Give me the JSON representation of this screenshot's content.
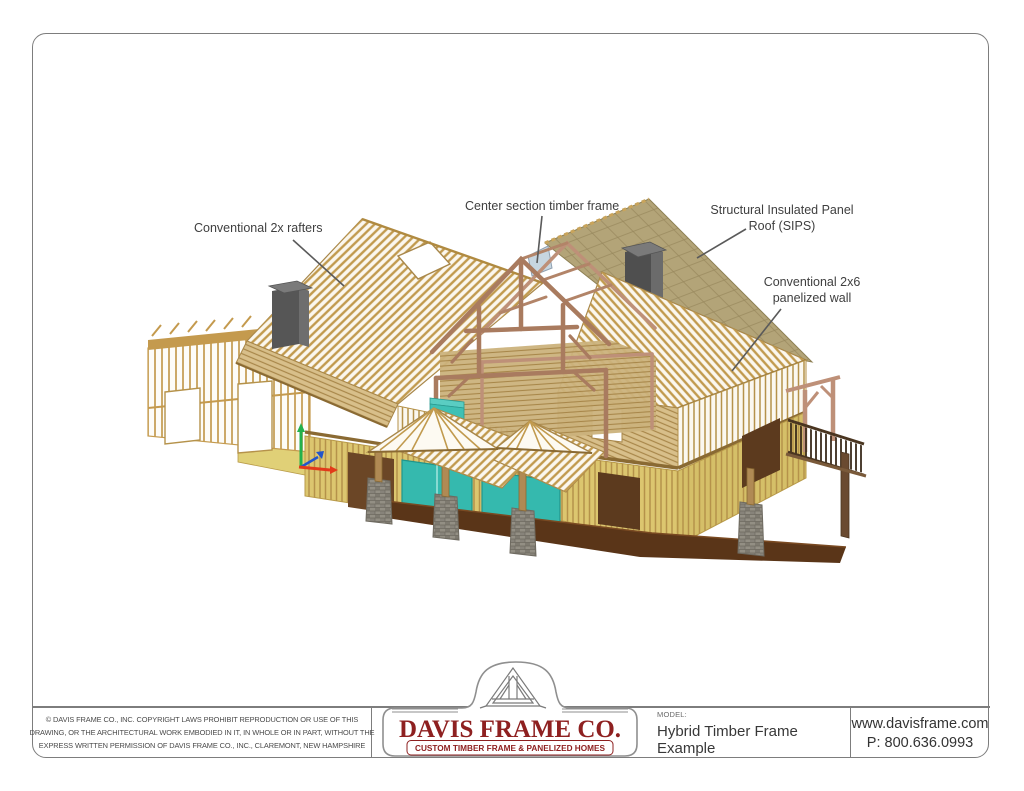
{
  "callouts": [
    {
      "id": "conventional-2x-rafters",
      "lines": [
        "Conventional 2x rafters"
      ]
    },
    {
      "id": "center-section-timber-frame",
      "lines": [
        "Center section timber frame"
      ]
    },
    {
      "id": "sips-roof",
      "lines": [
        "Structural Insulated Panel",
        "Roof (SIPS)"
      ]
    },
    {
      "id": "conventional-2x6-panelized-wall",
      "lines": [
        "Conventional 2x6",
        "panelized wall"
      ]
    }
  ],
  "title_block": {
    "copyright_lines": [
      "© DAVIS FRAME CO., INC. COPYRIGHT LAWS PROHIBIT REPRODUCTION OR USE OF THIS",
      "DRAWING, OR THE ARCHITECTURAL WORK EMBODIED IN IT, IN WHOLE OR IN PART, WITHOUT THE",
      "EXPRESS WRITTEN PERMISSION OF DAVIS FRAME CO., INC., CLAREMONT, NEW HAMPSHIRE"
    ],
    "logo": {
      "name": "DAVIS FRAME CO.",
      "tagline": "CUSTOM TIMBER FRAME & PANELIZED HOMES",
      "emblem_icon": "timber-truss-icon"
    },
    "model_label": "MODEL:",
    "model_value": "Hybrid Timber Frame Example",
    "website": "www.davisframe.com",
    "phone": "P: 800.636.0993"
  },
  "palette": {
    "logo_red": "#8E2020",
    "line_gray": "#7D7D7D",
    "label_text": "#3F3F3F",
    "lumber_gold": "#C49A4E",
    "lumber_light": "#D8BF8A",
    "timber_brown": "#A97B5F",
    "sips_tan": "#B3A478",
    "wall_yellow": "#DCC66F",
    "porch_floor_brown": "#5A3518",
    "glass_teal": "#35B9AE",
    "chimney_gray": "#5E5E5E",
    "stone_gray": "#938F84",
    "axis_green": "#22B14C",
    "axis_red": "#E23A1A",
    "axis_blue": "#2255CC"
  }
}
